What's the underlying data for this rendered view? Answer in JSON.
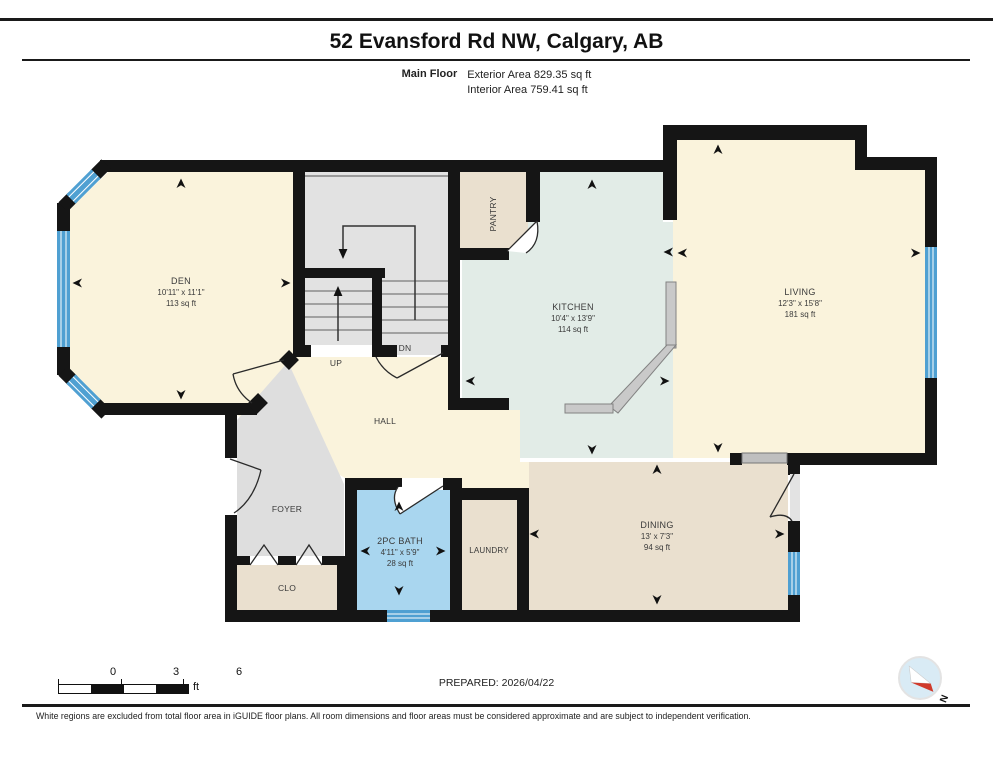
{
  "header": {
    "title": "52 Evansford Rd NW, Calgary, AB",
    "floor_label": "Main Floor",
    "exterior_area": "Exterior Area 829.35 sq ft",
    "interior_area": "Interior Area 759.41 sq ft"
  },
  "rooms": {
    "den": {
      "name": "DEN",
      "dims": "10'11\" x 11'1\"",
      "area": "113 sq ft"
    },
    "kitchen": {
      "name": "KITCHEN",
      "dims": "10'4\" x 13'9\"",
      "area": "114 sq ft"
    },
    "living": {
      "name": "LIVING",
      "dims": "12'3\" x 15'8\"",
      "area": "181 sq ft"
    },
    "dining": {
      "name": "DINING",
      "dims": "13' x 7'3\"",
      "area": "94 sq ft"
    },
    "bath": {
      "name": "2PC BATH",
      "dims": "4'11\" x 5'9\"",
      "area": "28 sq ft"
    },
    "laundry": {
      "name": "LAUNDRY"
    },
    "pantry": {
      "name": "PANTRY"
    },
    "hall": {
      "name": "HALL"
    },
    "foyer": {
      "name": "FOYER"
    },
    "closet": {
      "name": "CLO"
    },
    "stairs_up": "UP",
    "stairs_down": "DN"
  },
  "scale_bar": {
    "start": "0",
    "mid": "3",
    "end": "6",
    "unit": "ft"
  },
  "footer": {
    "prepared": "PREPARED: 2026/04/22",
    "compass_north": "N",
    "disclaimer": "White regions are excluded from total floor area in iGUIDE floor plans. All room dimensions and floor areas must be considered approximate and are subject to independent verification."
  },
  "colors": {
    "wall": "#151515",
    "room_cream": "#FAF3DC",
    "room_teal": "#E2ECE7",
    "room_tan": "#EAE0CF",
    "room_bath_blue": "#A9D6EF",
    "room_gray": "#DEDEDE",
    "stairs_gray": "#E2E2E2",
    "window_blue": "#4FA0D2",
    "counter_gray": "#C9C9C9",
    "compass_red": "#D03A2B"
  }
}
